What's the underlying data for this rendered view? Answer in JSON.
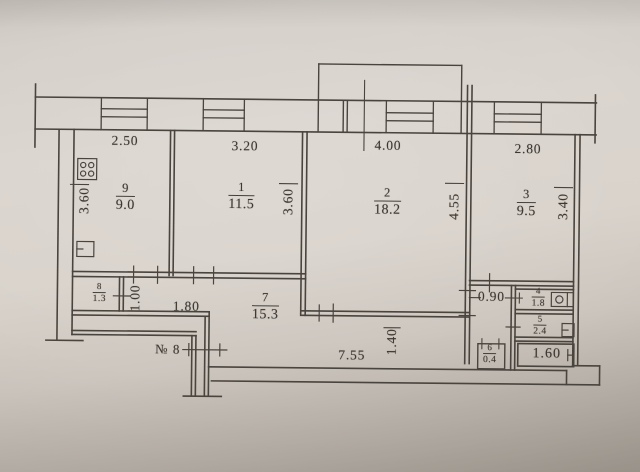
{
  "plan": {
    "apartment_number": "№ 8",
    "rooms": [
      {
        "name": "kitchen",
        "id": "9",
        "area": "9.0"
      },
      {
        "name": "room-1",
        "id": "1",
        "area": "11.5"
      },
      {
        "name": "room-2",
        "id": "2",
        "area": "18.2"
      },
      {
        "name": "room-3",
        "id": "3",
        "area": "9.5"
      },
      {
        "name": "closet-8",
        "id": "8",
        "area": "1.3"
      },
      {
        "name": "corridor",
        "id": "7",
        "area": "15.3"
      },
      {
        "name": "wc",
        "id": "4",
        "area": "1.8"
      },
      {
        "name": "bathroom",
        "id": "5",
        "area": "2.4"
      },
      {
        "name": "pantry",
        "id": "6",
        "area": "0.4"
      }
    ],
    "dimensions": {
      "top": [
        "2.50",
        "3.20",
        "4.00",
        "2.80"
      ],
      "kitchen_depth": "3.60",
      "room1_depth": "3.60",
      "room2_depth": "4.55",
      "room3_depth": "3.40",
      "closet_depth": "1.00",
      "hall_width": "1.80",
      "corridor_width": "1.40",
      "corridor_length": "7.55",
      "passage_width": "0.90",
      "bathtub_length": "1.60"
    },
    "icons": {
      "stove": "stove-icon",
      "kitchen_sink": "sink-icon",
      "wc_basin": "washbasin-icon",
      "bathroom_sink": "small-sink-icon",
      "bathtub": "bathtub-icon",
      "windows": "window-symbol"
    },
    "colors": {
      "paper": "#d9d3cc",
      "line": "#4a443e",
      "text": "#3e3832"
    }
  }
}
